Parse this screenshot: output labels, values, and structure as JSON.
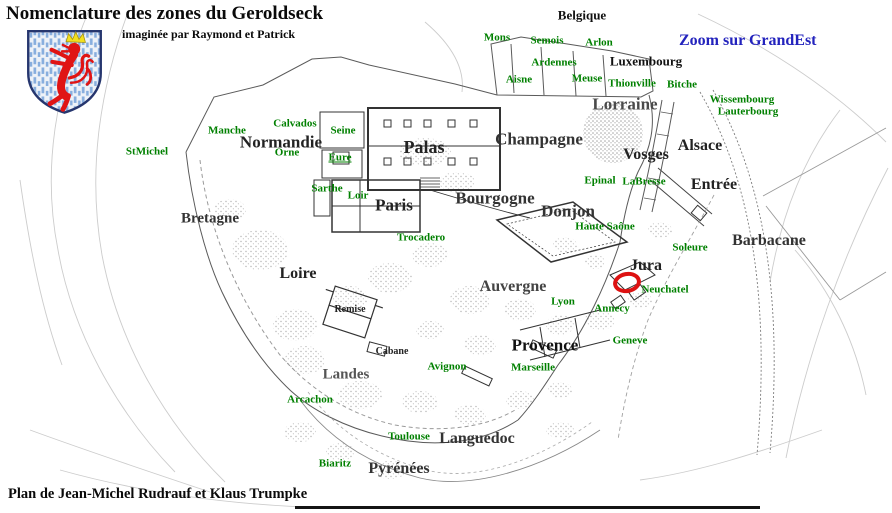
{
  "page": {
    "title": "Nomenclature des zones du Geroldseck",
    "subtitle": "imaginée par Raymond et Patrick",
    "credit": "Plan de Jean-Michel Rudrauf et Klaus Trumpke",
    "link_label": "Zoom sur GrandEst"
  },
  "palette": {
    "place_green": "#008000",
    "region_black": "#1a1a1a",
    "link_blue": "#2323bd",
    "marker_red": "#dd1111",
    "wall_gray": "#555555",
    "contour_gray": "#c9c9c9"
  },
  "map": {
    "regions": [
      {
        "id": "belgique",
        "text": "Belgique",
        "x": 582,
        "y": 15,
        "size": 13,
        "color": "#111111"
      },
      {
        "id": "luxembourg",
        "text": "Luxembourg",
        "x": 646,
        "y": 61,
        "size": 13,
        "color": "#111111"
      },
      {
        "id": "lorraine",
        "text": "Lorraine",
        "x": 625,
        "y": 104,
        "size": 17,
        "color": "#4a4a4a"
      },
      {
        "id": "vosges",
        "text": "Vosges",
        "x": 646,
        "y": 155,
        "size": 16,
        "color": "#222222"
      },
      {
        "id": "alsace",
        "text": "Alsace",
        "x": 700,
        "y": 146,
        "size": 16,
        "color": "#222222"
      },
      {
        "id": "entree",
        "text": "Entrée",
        "x": 714,
        "y": 185,
        "size": 16,
        "color": "#222222"
      },
      {
        "id": "champagne",
        "text": "Champagne",
        "x": 539,
        "y": 139,
        "size": 17,
        "color": "#333333"
      },
      {
        "id": "palas",
        "text": "Palas",
        "x": 424,
        "y": 147,
        "size": 18,
        "color": "#222222"
      },
      {
        "id": "normandie",
        "text": "Normandie",
        "x": 281,
        "y": 142,
        "size": 17,
        "color": "#222222"
      },
      {
        "id": "paris",
        "text": "Paris",
        "x": 394,
        "y": 205,
        "size": 17,
        "color": "#222222"
      },
      {
        "id": "bourgogne",
        "text": "Bourgogne",
        "x": 495,
        "y": 198,
        "size": 17,
        "color": "#333333"
      },
      {
        "id": "donjon",
        "text": "Donjon",
        "x": 568,
        "y": 211,
        "size": 17,
        "color": "#333333"
      },
      {
        "id": "bretagne",
        "text": "Bretagne",
        "x": 210,
        "y": 219,
        "size": 15,
        "color": "#333333"
      },
      {
        "id": "loire",
        "text": "Loire",
        "x": 298,
        "y": 274,
        "size": 16,
        "color": "#222222"
      },
      {
        "id": "remise",
        "text": "Remise",
        "x": 350,
        "y": 310,
        "size": 10,
        "color": "#222222"
      },
      {
        "id": "cabane",
        "text": "Cabane",
        "x": 392,
        "y": 352,
        "size": 10,
        "color": "#222222"
      },
      {
        "id": "landes",
        "text": "Landes",
        "x": 346,
        "y": 375,
        "size": 15,
        "color": "#555555"
      },
      {
        "id": "auvergne",
        "text": "Auvergne",
        "x": 513,
        "y": 287,
        "size": 16,
        "color": "#444444"
      },
      {
        "id": "provence",
        "text": "Provence",
        "x": 545,
        "y": 345,
        "size": 17,
        "color": "#111111"
      },
      {
        "id": "languedoc",
        "text": "Languedoc",
        "x": 477,
        "y": 439,
        "size": 16,
        "color": "#333333"
      },
      {
        "id": "pyrenees",
        "text": "Pyrénées",
        "x": 399,
        "y": 469,
        "size": 16,
        "color": "#333333"
      },
      {
        "id": "barbacane",
        "text": "Barbacane",
        "x": 769,
        "y": 241,
        "size": 16,
        "color": "#333333"
      },
      {
        "id": "jura",
        "text": "Jura",
        "x": 646,
        "y": 266,
        "size": 16,
        "color": "#222222"
      }
    ],
    "places": [
      {
        "id": "mons",
        "text": "Mons",
        "x": 497,
        "y": 38
      },
      {
        "id": "semois",
        "text": "Semois",
        "x": 547,
        "y": 41
      },
      {
        "id": "arlon",
        "text": "Arlon",
        "x": 599,
        "y": 43
      },
      {
        "id": "ardennes",
        "text": "Ardennes",
        "x": 554,
        "y": 63
      },
      {
        "id": "aisne",
        "text": "Aisne",
        "x": 519,
        "y": 80
      },
      {
        "id": "meuse",
        "text": "Meuse",
        "x": 587,
        "y": 79
      },
      {
        "id": "thionville",
        "text": "Thionville",
        "x": 632,
        "y": 84
      },
      {
        "id": "bitche",
        "text": "Bitche",
        "x": 682,
        "y": 85
      },
      {
        "id": "wissembourg",
        "text": "Wissembourg",
        "x": 742,
        "y": 100
      },
      {
        "id": "lauterbourg",
        "text": "Lauterbourg",
        "x": 748,
        "y": 112
      },
      {
        "id": "epinal",
        "text": "Epinal",
        "x": 600,
        "y": 181
      },
      {
        "id": "labresse",
        "text": "LaBresse",
        "x": 644,
        "y": 182
      },
      {
        "id": "haute-saone",
        "text": "Haute Saône",
        "x": 605,
        "y": 227
      },
      {
        "id": "soleure",
        "text": "Soleure",
        "x": 690,
        "y": 248
      },
      {
        "id": "neuchatel",
        "text": "Neuchatel",
        "x": 665,
        "y": 290
      },
      {
        "id": "annecy",
        "text": "Annecy",
        "x": 612,
        "y": 309
      },
      {
        "id": "geneve",
        "text": "Geneve",
        "x": 630,
        "y": 341
      },
      {
        "id": "lyon",
        "text": "Lyon",
        "x": 563,
        "y": 302
      },
      {
        "id": "marseille",
        "text": "Marseille",
        "x": 533,
        "y": 368
      },
      {
        "id": "avignon",
        "text": "Avignon",
        "x": 447,
        "y": 367
      },
      {
        "id": "trocadero",
        "text": "Trocadero",
        "x": 421,
        "y": 238
      },
      {
        "id": "stmichel",
        "text": "StMichel",
        "x": 147,
        "y": 152
      },
      {
        "id": "manche",
        "text": "Manche",
        "x": 227,
        "y": 131
      },
      {
        "id": "calvados",
        "text": "Calvados",
        "x": 295,
        "y": 124
      },
      {
        "id": "seine",
        "text": "Seine",
        "x": 343,
        "y": 131
      },
      {
        "id": "orne",
        "text": "Orne",
        "x": 287,
        "y": 153
      },
      {
        "id": "eure",
        "text": "Eure",
        "x": 340,
        "y": 158,
        "underline": true
      },
      {
        "id": "sarthe",
        "text": "Sarthe",
        "x": 327,
        "y": 189
      },
      {
        "id": "loir",
        "text": "Loir",
        "x": 358,
        "y": 196
      },
      {
        "id": "arcachon",
        "text": "Arcachon",
        "x": 310,
        "y": 400
      },
      {
        "id": "toulouse",
        "text": "Toulouse",
        "x": 409,
        "y": 437
      },
      {
        "id": "biaritz",
        "text": "Biaritz",
        "x": 335,
        "y": 464
      }
    ],
    "marker": {
      "id": "neuchatel-highlight",
      "x": 627,
      "y": 282,
      "w": 20,
      "h": 13,
      "stroke": 4,
      "color": "#dd1111"
    }
  }
}
